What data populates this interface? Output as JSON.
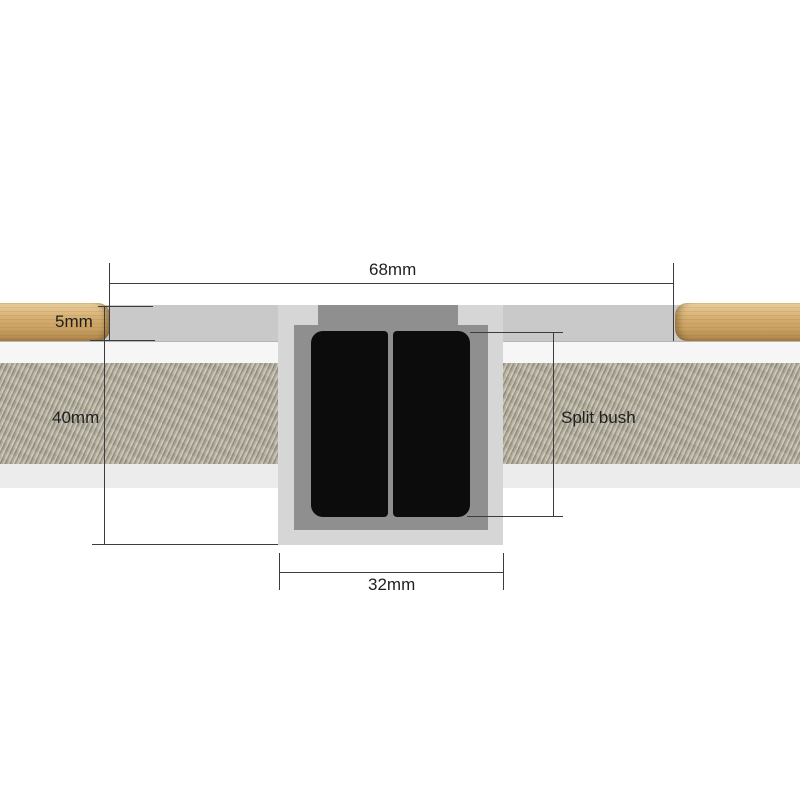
{
  "dimensions": {
    "overall_width": "68mm",
    "skim_thickness": "5mm",
    "wall_depth": "40mm",
    "bush_width": "32mm"
  },
  "callout": {
    "label": "Split bush"
  },
  "colors": {
    "band_top": "#c9c9c9",
    "band_white": "#f6f6f6",
    "band_lower": "#ececec",
    "texture_base": "#a9a494",
    "wood_mid": "#d4ad6e",
    "block": "#d6d6d6",
    "housing": "#8f8f8f",
    "bush": "#0c0c0c",
    "dim_line": "#3c3c3c",
    "text": "#1f1f1f"
  }
}
